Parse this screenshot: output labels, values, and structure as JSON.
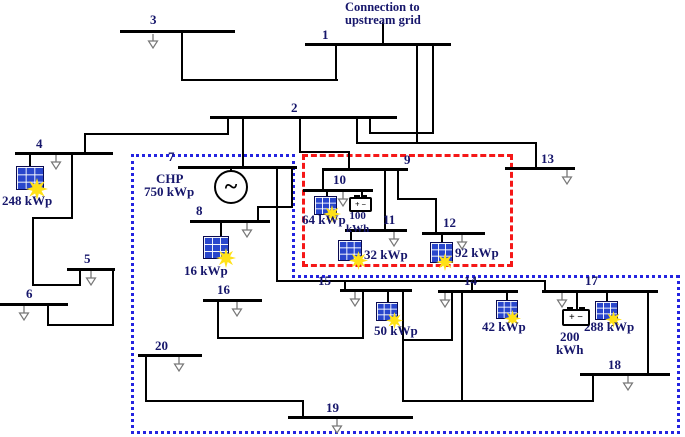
{
  "figure": {
    "title_note": {
      "lines": [
        "Connection to",
        "upstream grid"
      ],
      "x": 345,
      "y": 1
    },
    "colors": {
      "wire": "#000000",
      "label_text": "#16166b",
      "red_zone": "#f51818",
      "blue_zone": "#2424e0",
      "pv_panel": "#2946cc",
      "pv_sun": "#ffe117",
      "load_arrow": "#777777",
      "background": "#ffffff"
    },
    "buses": [
      {
        "label": "1",
        "x": 305,
        "y": 43,
        "w": 146,
        "lx": 322,
        "ly": 28
      },
      {
        "label": "2",
        "x": 210,
        "y": 116,
        "w": 187,
        "lx": 291,
        "ly": 101
      },
      {
        "label": "3",
        "x": 120,
        "y": 30,
        "w": 115,
        "lx": 150,
        "ly": 13
      },
      {
        "label": "4",
        "x": 15,
        "y": 152,
        "w": 98,
        "lx": 36,
        "ly": 137
      },
      {
        "label": "5",
        "x": 67,
        "y": 268,
        "w": 48,
        "lx": 84,
        "ly": 252
      },
      {
        "label": "6",
        "x": 0,
        "y": 303,
        "w": 68,
        "lx": 26,
        "ly": 287
      },
      {
        "label": "7",
        "x": 178,
        "y": 166,
        "w": 119,
        "lx": 168,
        "ly": 150
      },
      {
        "label": "8",
        "x": 190,
        "y": 220,
        "w": 80,
        "lx": 196,
        "ly": 204
      },
      {
        "label": "9",
        "x": 322,
        "y": 168,
        "w": 86,
        "lx": 404,
        "ly": 153
      },
      {
        "label": "10",
        "x": 303,
        "y": 189,
        "w": 70,
        "lx": 333,
        "ly": 173
      },
      {
        "label": "11",
        "x": 345,
        "y": 229,
        "w": 62,
        "lx": 383,
        "ly": 213
      },
      {
        "label": "12",
        "x": 422,
        "y": 232,
        "w": 63,
        "lx": 443,
        "ly": 216
      },
      {
        "label": "13",
        "x": 505,
        "y": 167,
        "w": 70,
        "lx": 541,
        "ly": 152
      },
      {
        "label": "14",
        "x": 438,
        "y": 290,
        "w": 80,
        "lx": 464,
        "ly": 274
      },
      {
        "label": "15",
        "x": 340,
        "y": 289,
        "w": 72,
        "lx": 318,
        "ly": 274
      },
      {
        "label": "16",
        "x": 203,
        "y": 299,
        "w": 59,
        "lx": 217,
        "ly": 283
      },
      {
        "label": "17",
        "x": 542,
        "y": 290,
        "w": 116,
        "lx": 585,
        "ly": 274
      },
      {
        "label": "18",
        "x": 580,
        "y": 373,
        "w": 90,
        "lx": 608,
        "ly": 358
      },
      {
        "label": "19",
        "x": 288,
        "y": 416,
        "w": 125,
        "lx": 326,
        "ly": 401
      },
      {
        "label": "20",
        "x": 138,
        "y": 354,
        "w": 64,
        "lx": 155,
        "ly": 339
      }
    ],
    "wires": [
      [
        382,
        22,
        2,
        23
      ],
      [
        181,
        31,
        2,
        50
      ],
      [
        181,
        79,
        157,
        2
      ],
      [
        335,
        45,
        2,
        36
      ],
      [
        416,
        46,
        2,
        98
      ],
      [
        432,
        46,
        2,
        88
      ],
      [
        369,
        132,
        65,
        2
      ],
      [
        369,
        119,
        2,
        15
      ],
      [
        356,
        142,
        181,
        2
      ],
      [
        356,
        119,
        2,
        25
      ],
      [
        535,
        142,
        2,
        27
      ],
      [
        227,
        119,
        2,
        16
      ],
      [
        84,
        133,
        145,
        2
      ],
      [
        84,
        133,
        2,
        21
      ],
      [
        242,
        119,
        2,
        49
      ],
      [
        299,
        119,
        2,
        34
      ],
      [
        299,
        151,
        51,
        2
      ],
      [
        348,
        151,
        2,
        19
      ],
      [
        71,
        155,
        2,
        64
      ],
      [
        32,
        217,
        41,
        2
      ],
      [
        32,
        217,
        2,
        69
      ],
      [
        32,
        284,
        49,
        2
      ],
      [
        79,
        271,
        2,
        15
      ],
      [
        112,
        271,
        2,
        55
      ],
      [
        47,
        324,
        67,
        2
      ],
      [
        47,
        306,
        2,
        20
      ],
      [
        230,
        169,
        2,
        5
      ],
      [
        291,
        169,
        2,
        39
      ],
      [
        257,
        206,
        36,
        2
      ],
      [
        257,
        206,
        2,
        16
      ],
      [
        276,
        169,
        2,
        113
      ],
      [
        276,
        280,
        270,
        2
      ],
      [
        344,
        280,
        2,
        11
      ],
      [
        471,
        280,
        2,
        12
      ],
      [
        544,
        280,
        2,
        12
      ],
      [
        322,
        171,
        2,
        20
      ],
      [
        384,
        171,
        2,
        60
      ],
      [
        397,
        171,
        2,
        29
      ],
      [
        397,
        198,
        40,
        2
      ],
      [
        435,
        198,
        2,
        36
      ],
      [
        362,
        292,
        2,
        47
      ],
      [
        217,
        337,
        147,
        2
      ],
      [
        217,
        302,
        2,
        37
      ],
      [
        402,
        292,
        2,
        110
      ],
      [
        402,
        339,
        51,
        2
      ],
      [
        451,
        293,
        2,
        48
      ],
      [
        461,
        293,
        2,
        109
      ],
      [
        402,
        400,
        192,
        2
      ],
      [
        592,
        376,
        2,
        26
      ],
      [
        647,
        293,
        2,
        82
      ],
      [
        145,
        357,
        2,
        45
      ],
      [
        145,
        400,
        159,
        2
      ],
      [
        302,
        400,
        2,
        18
      ]
    ],
    "loads": [
      [
        153,
        34
      ],
      [
        56,
        155
      ],
      [
        91,
        271
      ],
      [
        24,
        306
      ],
      [
        247,
        223
      ],
      [
        343,
        192
      ],
      [
        394,
        232
      ],
      [
        462,
        235
      ],
      [
        567,
        170
      ],
      [
        445,
        293
      ],
      [
        355,
        292
      ],
      [
        237,
        302
      ],
      [
        562,
        293
      ],
      [
        628,
        376
      ],
      [
        337,
        419
      ],
      [
        179,
        357
      ]
    ],
    "pv_units": [
      {
        "label": "248 kWp",
        "stem": [
          29,
          155,
          13
        ],
        "panel": [
          16,
          166,
          28,
          24
        ],
        "sun": [
          26,
          178,
          22
        ],
        "tx": 2,
        "ty": 194
      },
      {
        "label": "16 kWp",
        "stem": [
          220,
          223,
          15
        ],
        "panel": [
          203,
          236,
          26,
          23
        ],
        "sun": [
          216,
          248,
          20
        ],
        "tx": 184,
        "ty": 264
      },
      {
        "label": "64 kWp",
        "stem": [
          326,
          192,
          6
        ],
        "panel": [
          314,
          196,
          23,
          19
        ],
        "sun": [
          323,
          205,
          18
        ],
        "tx": 302,
        "ty": 213
      },
      {
        "label": "32 kWp",
        "stem": [
          350,
          232,
          9
        ],
        "panel": [
          338,
          240,
          24,
          21
        ],
        "sun": [
          349,
          251,
          19
        ],
        "tx": 364,
        "ty": 248
      },
      {
        "label": "92 kWp",
        "stem": [
          441,
          235,
          8
        ],
        "panel": [
          430,
          242,
          23,
          21
        ],
        "sun": [
          436,
          253,
          18
        ],
        "tx": 455,
        "ty": 246
      },
      {
        "label": "50 kWp",
        "stem": [
          387,
          292,
          11
        ],
        "panel": [
          376,
          302,
          22,
          19
        ],
        "sun": [
          386,
          312,
          17
        ],
        "tx": 374,
        "ty": 324
      },
      {
        "label": "42 kWp",
        "stem": [
          506,
          293,
          8
        ],
        "panel": [
          496,
          300,
          22,
          19
        ],
        "sun": [
          504,
          310,
          17
        ],
        "tx": 482,
        "ty": 320
      },
      {
        "label": "288 kWp",
        "stem": [
          606,
          293,
          9
        ],
        "panel": [
          595,
          301,
          23,
          19
        ],
        "sun": [
          605,
          311,
          17
        ],
        "tx": 584,
        "ty": 320
      }
    ],
    "batteries": [
      {
        "capacity_lines": [
          "100",
          "kWh"
        ],
        "terminals": "+ −",
        "stem": [
          361,
          192,
          6
        ],
        "box": [
          349,
          197,
          23,
          15
        ],
        "tx": 346,
        "ty": 210,
        "fs": 11,
        "tfs": 8
      },
      {
        "capacity_lines": [
          "200",
          "kWh"
        ],
        "terminals": "+ −",
        "stem": [
          576,
          293,
          17
        ],
        "box": [
          562,
          309,
          28,
          17
        ],
        "tx": 556,
        "ty": 330,
        "fs": 13,
        "tfs": 10
      }
    ],
    "chp": {
      "name": "CHP",
      "rating": "750 kWp",
      "symbol": "~",
      "circle": [
        214,
        170,
        34
      ],
      "name_x": 156,
      "name_y": 172,
      "rating_x": 144,
      "rating_y": 185
    },
    "zones": {
      "red_dashed": [
        302,
        154,
        211,
        113
      ],
      "blue_dotted_segments": [
        [
          131,
          154,
          164,
          0
        ],
        [
          292,
          154,
          0,
          124
        ],
        [
          292,
          275,
          387,
          0
        ],
        [
          677,
          275,
          0,
          159
        ],
        [
          131,
          431,
          549,
          0
        ],
        [
          131,
          154,
          0,
          280
        ]
      ]
    }
  }
}
